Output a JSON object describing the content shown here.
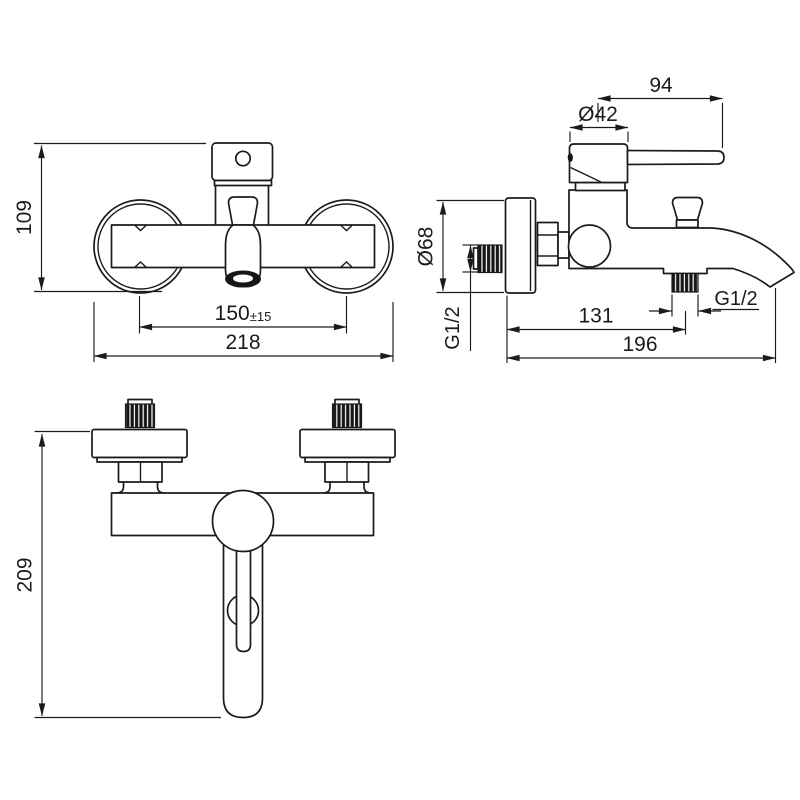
{
  "meta": {
    "title": "Wall-mounted bath mixer tap — dimensional technical drawing",
    "view_count": "3"
  },
  "colors": {
    "background": "#ffffff",
    "line": "#1b1b1b",
    "thread_fill": "#161616"
  },
  "views": {
    "front": {
      "name": "front view",
      "dims": {
        "height": "109",
        "centers": "150",
        "centers_tol": "±15",
        "width": "218"
      }
    },
    "side": {
      "name": "side view",
      "dims": {
        "lever": "94",
        "handle_dia": "Ø42",
        "plate_dia": "Ø68",
        "inlet_thread": "G1/2",
        "outlet_offset": "131",
        "outlet_thread": "G1/2",
        "depth": "196"
      }
    },
    "bottom": {
      "name": "bottom view",
      "dims": {
        "height": "209"
      }
    }
  }
}
